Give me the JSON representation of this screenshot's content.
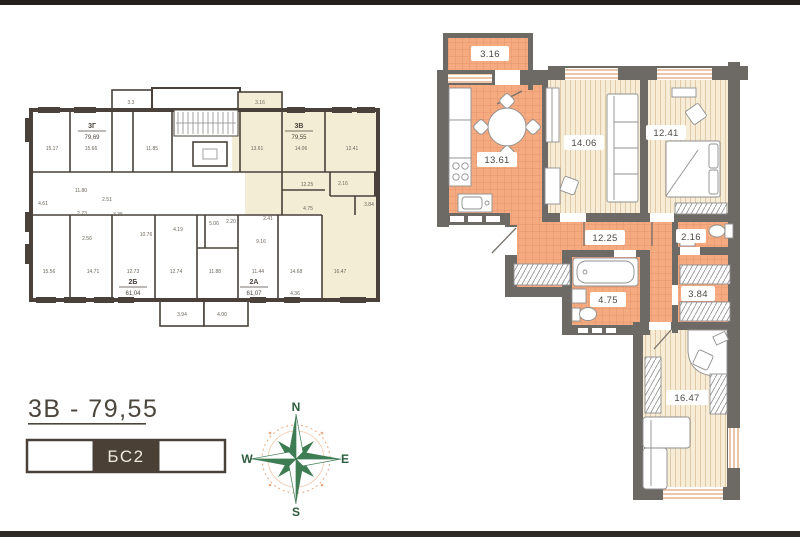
{
  "footer": {
    "apartment_title": "3В - 79,55",
    "block_label": "БС2"
  },
  "compass": {
    "north": "N",
    "south": "S",
    "west": "W",
    "east": "E"
  },
  "mini_plan": {
    "apartments": [
      {
        "name": "3Г",
        "area": "79,69"
      },
      {
        "name": "3В",
        "area": "79,55"
      },
      {
        "name": "2Б",
        "area": "61,04"
      },
      {
        "name": "2А",
        "area": "61,07"
      }
    ],
    "room_labels": [
      "15.17",
      "15.66",
      "11.85",
      "3.3",
      "3.16",
      "13.61",
      "14.06",
      "12.41",
      "11.80",
      "2.51",
      "4.61",
      "2.73",
      "3.35",
      "4.19",
      "2.56",
      "10.76",
      "15.56",
      "14.71",
      "12.73",
      "12.74",
      "5.06",
      "2.20",
      "9.16",
      "2.41",
      "4.75",
      "12.25",
      "2.16",
      "3.84",
      "11.88",
      "11.44",
      "14.68",
      "4.36",
      "16.47",
      "3.94",
      "4.00"
    ]
  },
  "detail_plan": {
    "rooms": [
      {
        "type": "balcony",
        "area": "3.16"
      },
      {
        "type": "kitchen",
        "area": "13.61"
      },
      {
        "type": "living",
        "area": "14.06"
      },
      {
        "type": "bedroom",
        "area": "12.41"
      },
      {
        "type": "hallway",
        "area": "12.25"
      },
      {
        "type": "wc",
        "area": "2.16"
      },
      {
        "type": "bathroom",
        "area": "4.75"
      },
      {
        "type": "storage",
        "area": "3.84"
      },
      {
        "type": "bedroom2",
        "area": "16.47"
      }
    ]
  },
  "colors": {
    "highlight": "#f4edd6",
    "tile": "#f5aa80",
    "wood": "#f7ecd6",
    "wall_dark": "#49413a",
    "wall_gray": "#6d6a66",
    "compass_green": "#3e7c54",
    "compass_orange": "#e8a87f"
  }
}
